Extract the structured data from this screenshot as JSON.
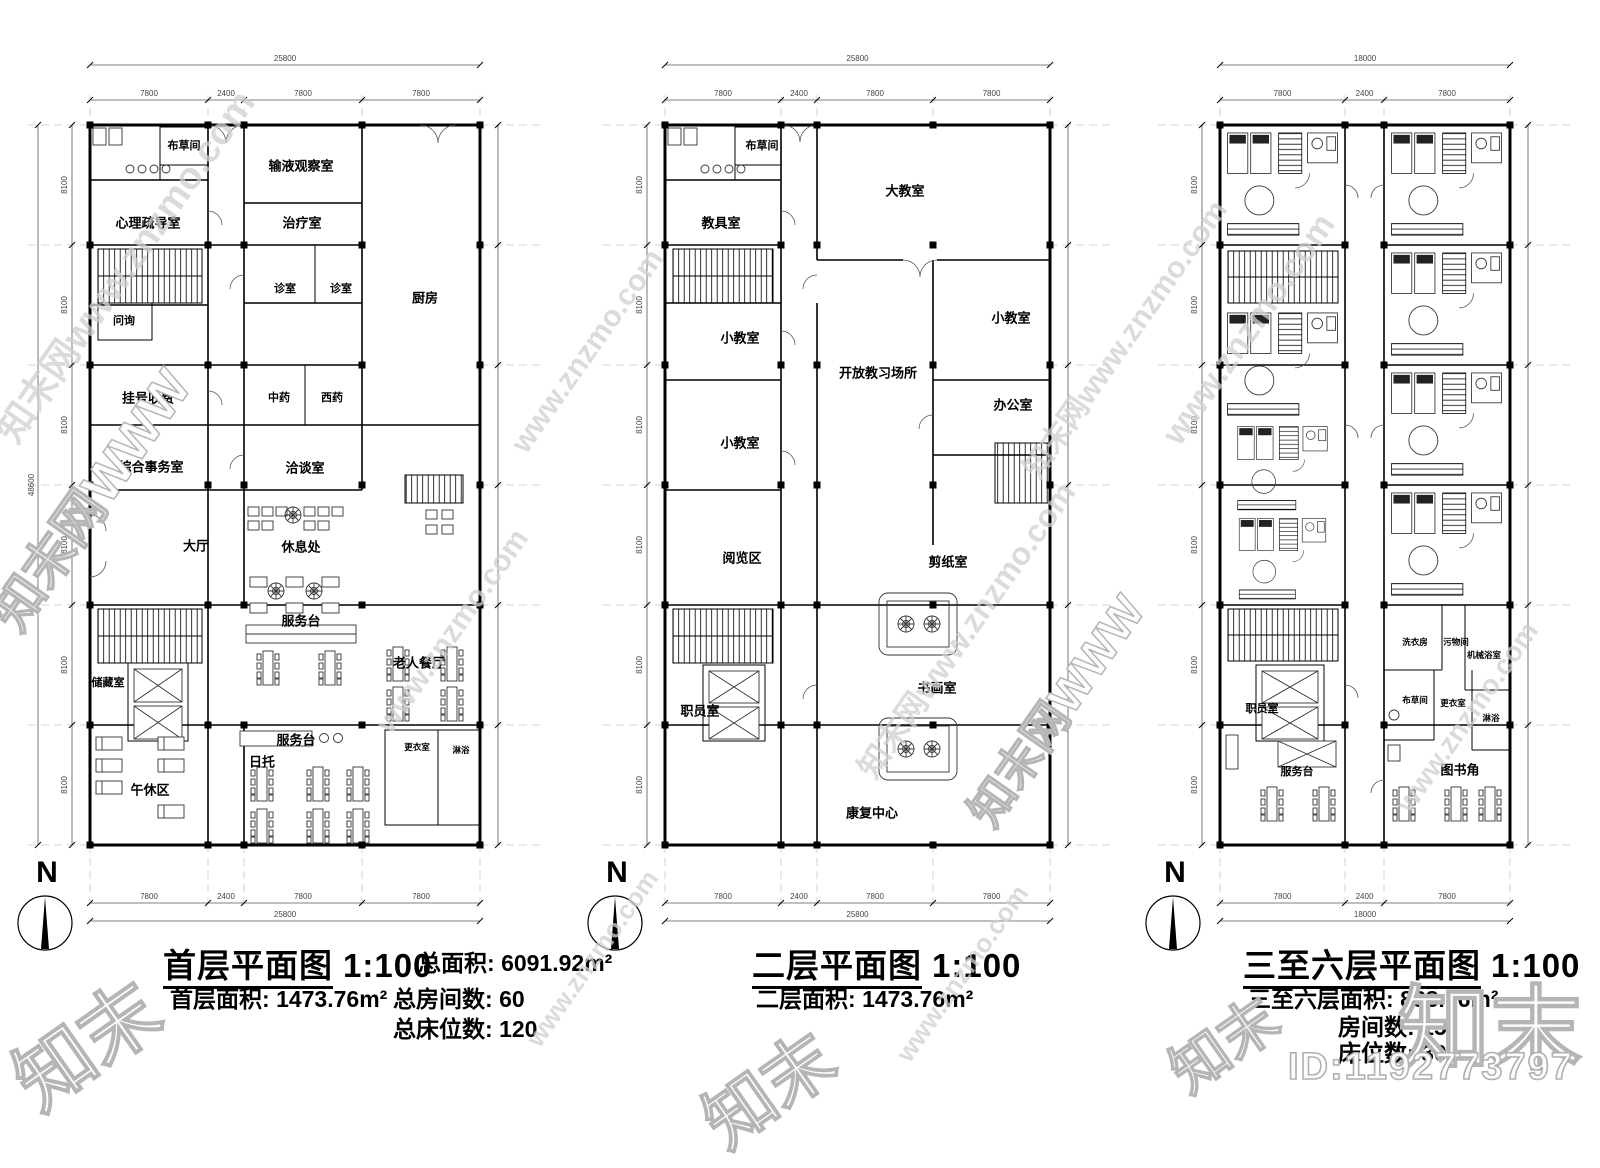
{
  "north": "N",
  "id_text": "ID:1192773797",
  "watermarks": {
    "url": "www.znzmo.com",
    "site": "知末网www.znzmo.com",
    "brand": "知末",
    "site_short": "知末网WWW"
  },
  "plans": [
    {
      "title": "首层平面图",
      "scale": "1:100",
      "dim_total": "25800",
      "dims": [
        "7800",
        "2400",
        "7800",
        "7800"
      ],
      "vdim": "8100",
      "vdim_total": "48600",
      "stats": {
        "area_k": "总面积:",
        "area_v": "6091.92m²",
        "floor_k": "首层面积:",
        "floor_v": "1473.76m²",
        "rooms_k": "总房间数:",
        "rooms_v": "60",
        "beds_k": "总床位数:",
        "beds_v": "120"
      },
      "rooms": {
        "bucaojian": "布草间",
        "xinli": "心理疏导室",
        "shuye": "输液观察室",
        "zhiliao": "治疗室",
        "chufang": "厨房",
        "zhenshi1": "诊室",
        "zhenshi2": "诊室",
        "wenxun": "问询",
        "guahao": "挂号收费",
        "zhongyao": "中药",
        "xiyao": "西药",
        "zonghe": "综合事务室",
        "qiatan": "洽谈室",
        "dating": "大厅",
        "xiuxichu": "休息处",
        "fuwutai1": "服务台",
        "cangchu": "储藏室",
        "canting": "老人餐厅",
        "wuxiuqu": "午休区",
        "rituo": "日托",
        "fuwutai2": "服务台",
        "gengyi": "更衣室",
        "linyu": "淋浴"
      }
    },
    {
      "title": "二层平面图",
      "scale": "1:100",
      "dim_total": "25800",
      "dims": [
        "7800",
        "2400",
        "7800",
        "7800"
      ],
      "vdim": "8100",
      "vdim_total": "48600",
      "stats": {
        "floor_k": "二层面积:",
        "floor_v": "1473.76m²"
      },
      "rooms": {
        "bucaojian": "布草间",
        "jiaojushi": "教具室",
        "dajiaoshi": "大教室",
        "xiaojiaoshi_a": "小教室",
        "xiaojiaoshi_b": "小教室",
        "xiaojiaoshi_c": "小教室",
        "kaifang": "开放教习场所",
        "bangongshi": "办公室",
        "yuelanqu": "阅览区",
        "jianzhishi": "剪纸室",
        "zhiyuanshi": "职员室",
        "shuhuashi": "书画室",
        "kangfu": "康复中心"
      }
    },
    {
      "title": "三至六层平面图",
      "scale": "1:100",
      "dim_total": "18000",
      "dims": [
        "7800",
        "2400",
        "7800"
      ],
      "vdim": "8100",
      "vdim_total": "48600",
      "stats": {
        "floor_k": "三至六层面积:",
        "floor_v": "888.16m²",
        "rooms_k": "房间数:",
        "rooms_v": "15",
        "beds_k": "床位数:",
        "beds_v": "30"
      },
      "rooms": {
        "xiyifang": "洗衣房",
        "wuwujian": "污物间",
        "jixie": "机械浴室",
        "bucaojian": "布草间",
        "gengyi": "更衣室",
        "linyu": "淋浴",
        "zhiyuanshi": "职员室",
        "fuwutai": "服务台",
        "tushujiao": "图书角"
      }
    }
  ]
}
